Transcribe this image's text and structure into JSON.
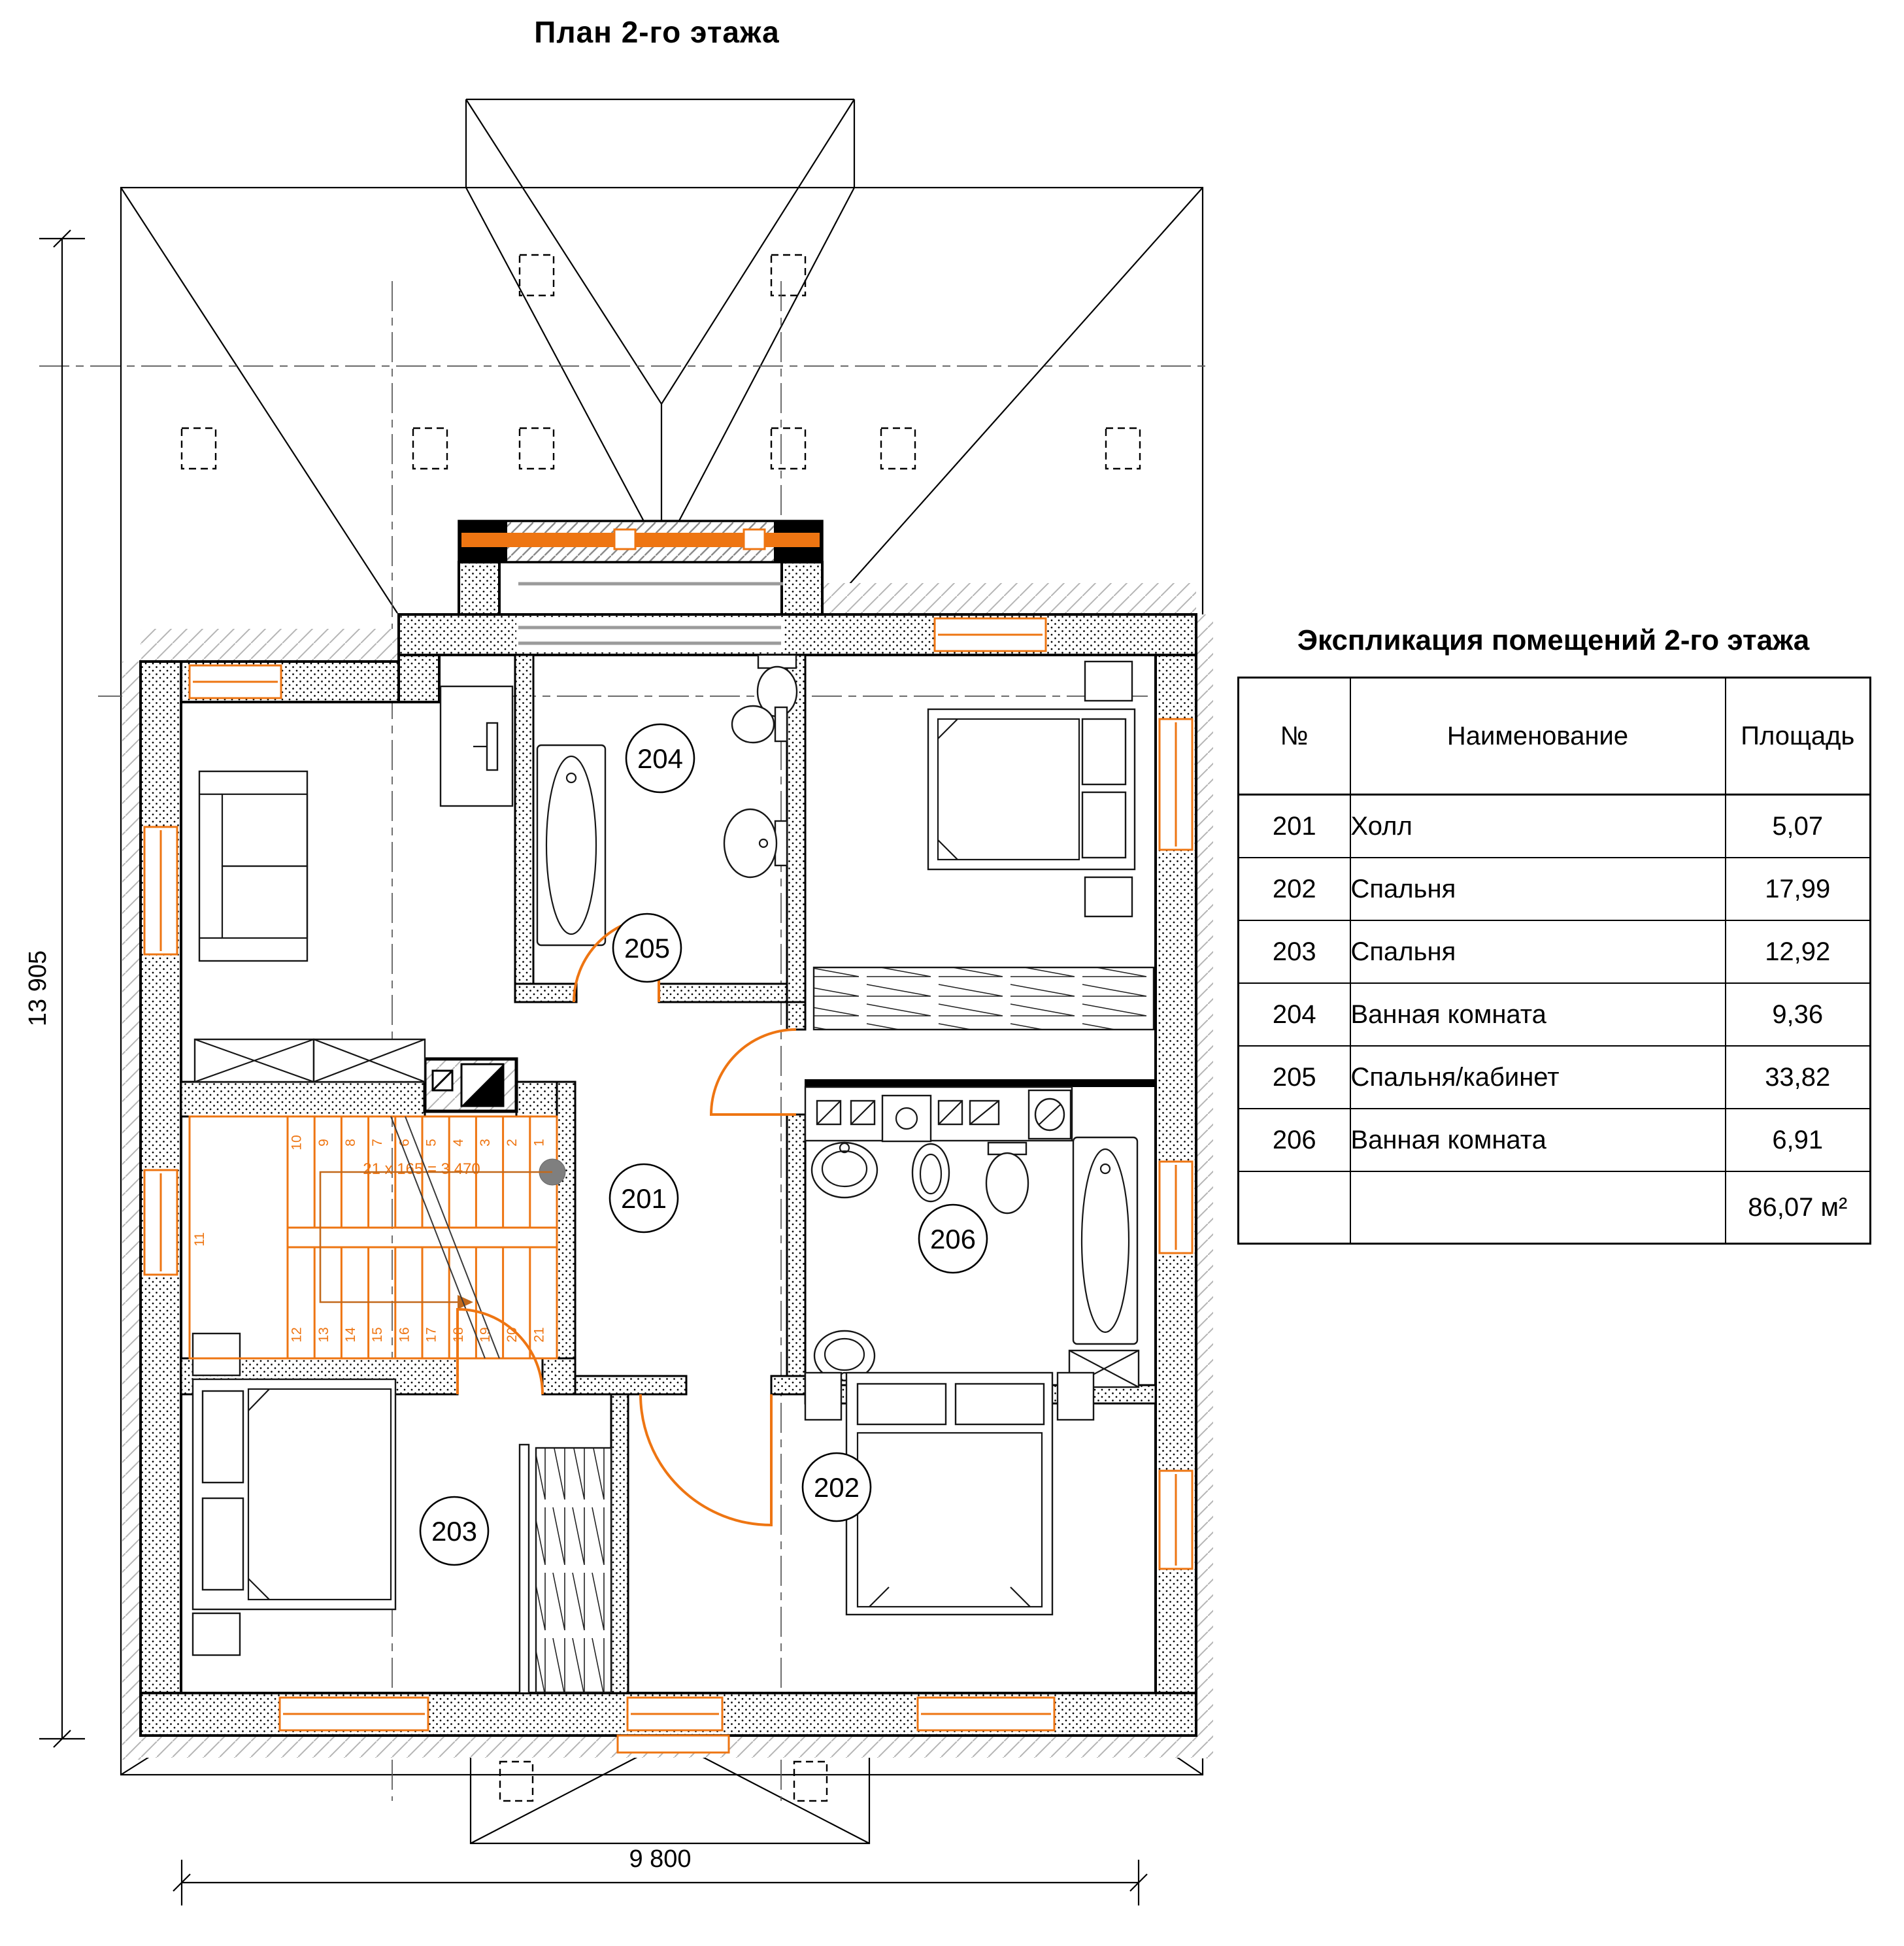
{
  "drawing": {
    "title": "План 2-го этажа",
    "dimensions": {
      "height_total": "13 905",
      "width_total": "9 800"
    },
    "stairs": {
      "note": "21 x 165 = 3 470",
      "flight_up_treads": [
        "1",
        "2",
        "3",
        "4",
        "5",
        "6",
        "7",
        "8",
        "9",
        "10"
      ],
      "landing_tread": "11",
      "flight_down_treads": [
        "12",
        "13",
        "14",
        "15",
        "16",
        "17",
        "18",
        "19",
        "20",
        "21"
      ]
    },
    "rooms": [
      {
        "number": "201",
        "name": "Холл"
      },
      {
        "number": "202",
        "name": "Спальня"
      },
      {
        "number": "203",
        "name": "Спальня"
      },
      {
        "number": "204",
        "name": "Ванная комната"
      },
      {
        "number": "205",
        "name": "Спальня/кабинет"
      },
      {
        "number": "206",
        "name": "Ванная комната"
      }
    ]
  },
  "schedule": {
    "title": "Экспликация помещений 2-го этажа",
    "columns": [
      "№",
      "Наименование",
      "Площадь"
    ],
    "rows": [
      [
        "201",
        "Холл",
        "5,07"
      ],
      [
        "202",
        "Спальня",
        "17,99"
      ],
      [
        "203",
        "Спальня",
        "12,92"
      ],
      [
        "204",
        "Ванная комната",
        "9,36"
      ],
      [
        "205",
        "Спальня/кабинет",
        "33,82"
      ],
      [
        "206",
        "Ванная комната",
        "6,91"
      ]
    ],
    "total_area": "86,07 м²"
  },
  "colors": {
    "accent_orange": "#EE7512",
    "glazing_gray": "#9B9B9B",
    "line_black": "#000000",
    "walk_dot_gray": "#7F7F7F"
  }
}
